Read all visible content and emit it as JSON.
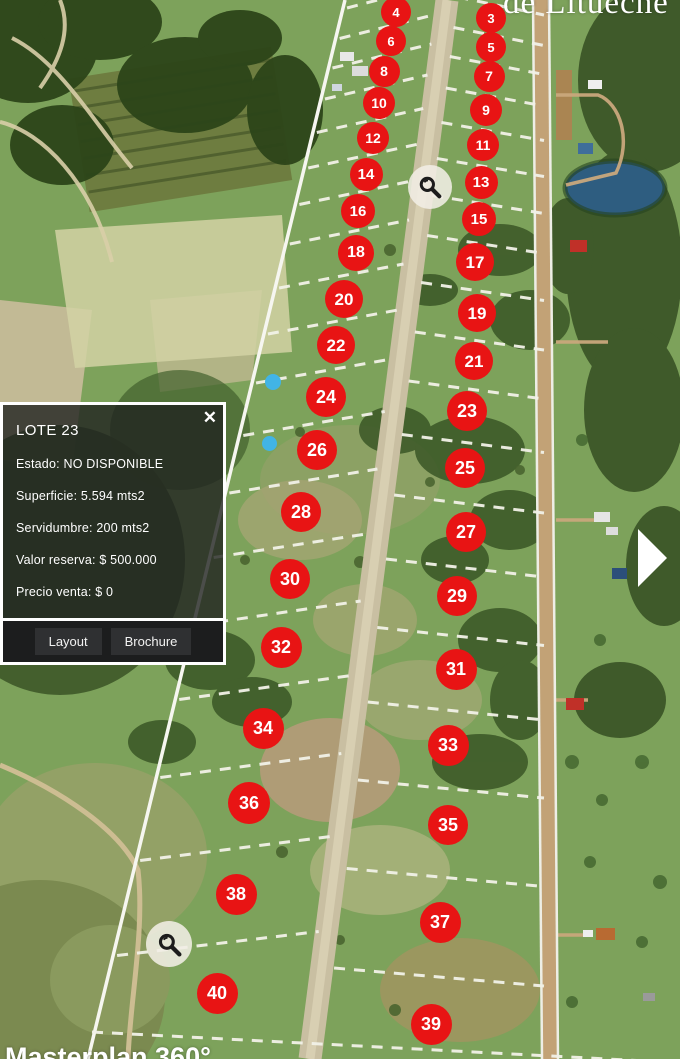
{
  "watermarks": {
    "top": "de Litueche",
    "bottom": "Masterplan 360°"
  },
  "popup": {
    "title": "LOTE 23",
    "close_label": "✕",
    "lines": [
      "Estado: NO DISPONIBLE",
      "Superficie: 5.594 mts2",
      "Servidumbre: 200 mts2",
      "Valor reserva: $ 500.000",
      "Precio venta: $ 0"
    ],
    "buttons": [
      "Layout",
      "Brochure"
    ]
  },
  "icons": {
    "zoom_point": "magnifier-icon",
    "close": "close-icon",
    "next": "next-arrow-icon"
  },
  "colors": {
    "marker_red": "#e81414",
    "dot_blue": "#41b4e6",
    "dash_white": "#f2f2e8",
    "road_tan": "#c9bfa2"
  },
  "markers": [
    {
      "n": 3,
      "x": 491,
      "y": 18,
      "d": 30
    },
    {
      "n": 5,
      "x": 491,
      "y": 47,
      "d": 30
    },
    {
      "n": 7,
      "x": 489,
      "y": 76,
      "d": 31
    },
    {
      "n": 9,
      "x": 486,
      "y": 110,
      "d": 32
    },
    {
      "n": 11,
      "x": 483,
      "y": 145,
      "d": 32
    },
    {
      "n": 13,
      "x": 481,
      "y": 182,
      "d": 33
    },
    {
      "n": 15,
      "x": 479,
      "y": 219,
      "d": 34
    },
    {
      "n": 17,
      "x": 475,
      "y": 262,
      "d": 38
    },
    {
      "n": 19,
      "x": 477,
      "y": 313,
      "d": 38
    },
    {
      "n": 21,
      "x": 474,
      "y": 361,
      "d": 38
    },
    {
      "n": 23,
      "x": 467,
      "y": 411,
      "d": 40
    },
    {
      "n": 25,
      "x": 465,
      "y": 468,
      "d": 40
    },
    {
      "n": 27,
      "x": 466,
      "y": 532,
      "d": 40
    },
    {
      "n": 29,
      "x": 457,
      "y": 596,
      "d": 40
    },
    {
      "n": 31,
      "x": 456,
      "y": 669,
      "d": 41
    },
    {
      "n": 33,
      "x": 448,
      "y": 745,
      "d": 41
    },
    {
      "n": 35,
      "x": 448,
      "y": 825,
      "d": 40
    },
    {
      "n": 37,
      "x": 440,
      "y": 922,
      "d": 41
    },
    {
      "n": 39,
      "x": 431,
      "y": 1024,
      "d": 41
    },
    {
      "n": 4,
      "x": 396,
      "y": 12,
      "d": 30
    },
    {
      "n": 6,
      "x": 391,
      "y": 41,
      "d": 30
    },
    {
      "n": 8,
      "x": 384,
      "y": 71,
      "d": 31
    },
    {
      "n": 10,
      "x": 379,
      "y": 103,
      "d": 32
    },
    {
      "n": 12,
      "x": 373,
      "y": 138,
      "d": 32
    },
    {
      "n": 14,
      "x": 366,
      "y": 174,
      "d": 33
    },
    {
      "n": 16,
      "x": 358,
      "y": 211,
      "d": 34
    },
    {
      "n": 18,
      "x": 356,
      "y": 253,
      "d": 36
    },
    {
      "n": 20,
      "x": 344,
      "y": 299,
      "d": 38
    },
    {
      "n": 22,
      "x": 336,
      "y": 345,
      "d": 38
    },
    {
      "n": 24,
      "x": 326,
      "y": 397,
      "d": 40
    },
    {
      "n": 26,
      "x": 317,
      "y": 450,
      "d": 40
    },
    {
      "n": 28,
      "x": 301,
      "y": 512,
      "d": 40
    },
    {
      "n": 30,
      "x": 290,
      "y": 579,
      "d": 40
    },
    {
      "n": 32,
      "x": 281,
      "y": 647,
      "d": 41
    },
    {
      "n": 34,
      "x": 263,
      "y": 728,
      "d": 41
    },
    {
      "n": 36,
      "x": 249,
      "y": 803,
      "d": 42
    },
    {
      "n": 38,
      "x": 236,
      "y": 894,
      "d": 41
    },
    {
      "n": 40,
      "x": 217,
      "y": 993,
      "d": 41
    }
  ],
  "poi": {
    "zoom_points": [
      {
        "x": 430,
        "y": 187,
        "d": 44
      },
      {
        "x": 169,
        "y": 944,
        "d": 46
      }
    ],
    "blue_dots": [
      {
        "x": 273,
        "y": 382,
        "d": 16
      },
      {
        "x": 269,
        "y": 443,
        "d": 15
      }
    ]
  }
}
